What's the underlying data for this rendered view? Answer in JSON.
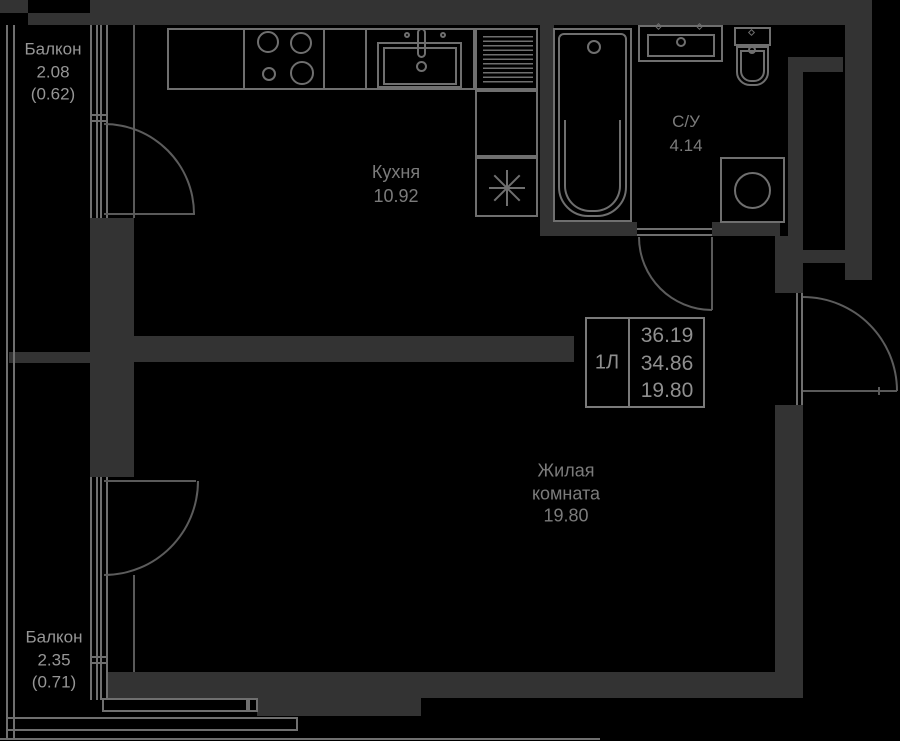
{
  "plan_title": "apartment-floor-plan",
  "colors": {
    "background": "#000000",
    "wall_fill": "#333333",
    "outline": "#6f6f6f",
    "door_arc": "#5c5c5c",
    "label_dim": "#7b7b7b",
    "label_bright": "#969696"
  },
  "balcony_top": {
    "name": "Балкон",
    "area": "2.08",
    "reduced_area": "(0.62)"
  },
  "balcony_bottom": {
    "name": "Балкон",
    "area": "2.35",
    "reduced_area": "(0.71)"
  },
  "kitchen": {
    "name": "Кухня",
    "area": "10.92"
  },
  "bathroom": {
    "name": "С/У",
    "area": "4.14"
  },
  "living_room": {
    "name_line1": "Жилая",
    "name_line2": "комната",
    "area": "19.80"
  },
  "info_box": {
    "unit_label": "1Л",
    "total_area": "36.19",
    "area_without_balcony": "34.86",
    "living_area": "19.80"
  }
}
